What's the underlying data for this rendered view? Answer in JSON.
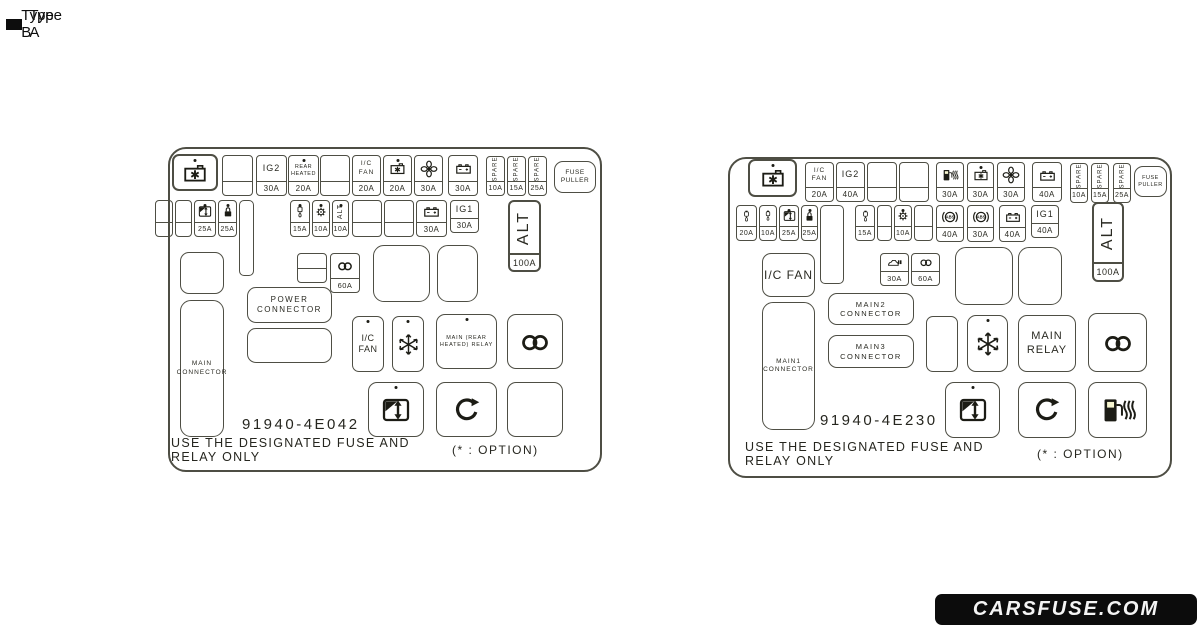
{
  "colors": {
    "panel_bg": "#f7f6d0",
    "line": "#4e4e44",
    "ink": "#2a2a22",
    "logo_bg": "#0c0c0c",
    "logo_text": "#f4f4f4"
  },
  "icons": {
    "battery_charge": "battery-charge-icon",
    "battery": "battery-icon",
    "fan": "fan-icon",
    "power_window": "power-window-icon",
    "door_lock": "door-lock-icon",
    "washer": "washer-fluid-icon",
    "gear": "gear-icon",
    "snowflake": "snowflake-icon",
    "coil": "coil-icon",
    "abs": "abs-icon",
    "fuel_heater": "fuel-heater-icon",
    "rotate": "rotate-arrow-icon",
    "car_wash": "car-wash-icon"
  },
  "type_a": {
    "title": "Type A",
    "part_number": "91940-4E042",
    "warning_line1": "USE THE DESIGNATED FUSE AND",
    "warning_line2": "RELAY ONLY",
    "option_note": "(* :  OPTION)",
    "fuses": {
      "ig2": {
        "label": "IG2",
        "amp": "30A"
      },
      "rear_heated": {
        "label": "REAR HEATED",
        "amp": "20A"
      },
      "ic_fan": {
        "label": "I/C FAN",
        "amp": "20A"
      },
      "battery_charge": {
        "amp": "20A"
      },
      "fan": {
        "amp": "30A"
      },
      "battery_a": {
        "amp": "30A"
      },
      "spare_1": {
        "label": "SPARE",
        "amp": "10A"
      },
      "spare_2": {
        "label": "SPARE",
        "amp": "15A"
      },
      "spare_3": {
        "label": "SPARE",
        "amp": "25A"
      },
      "fuse_puller": {
        "label": "FUSE PULLER"
      },
      "window": {
        "amp": "25A"
      },
      "door_lock": {
        "amp": "25A"
      },
      "washer": {
        "amp": "15A"
      },
      "gear": {
        "amp": "10A"
      },
      "alt_small": {
        "label": "ALT",
        "amp": "10A"
      },
      "battery_b": {
        "amp": "30A"
      },
      "ig1": {
        "label": "IG1",
        "amp": "30A"
      },
      "alt_main": {
        "label": "ALT",
        "amp": "100A"
      },
      "coil": {
        "amp": "60A"
      }
    },
    "boxes": {
      "main_connector": "MAIN CONNECTOR",
      "power_connector": "POWER CONNECTOR",
      "ic_fan_relay": "I/C FAN",
      "main_rear_heated_relay": "MAIN (REAR HEATED) RELAY"
    }
  },
  "type_b": {
    "title": "Type B",
    "part_number": "91940-4E230",
    "warning_line1": "USE THE DESIGNATED FUSE AND",
    "warning_line2": "RELAY ONLY",
    "option_note": "(* :  OPTION)",
    "fuses": {
      "ic_fan": {
        "label": "I/C FAN",
        "amp": "20A"
      },
      "ig2": {
        "label": "IG2",
        "amp": "40A"
      },
      "fuel_heater": {
        "amp": "30A"
      },
      "battery_charge": {
        "amp": "30A"
      },
      "fan": {
        "amp": "30A"
      },
      "battery_a": {
        "amp": "40A"
      },
      "spare_1": {
        "label": "SPARE",
        "amp": "10A"
      },
      "spare_2": {
        "label": "SPARE",
        "amp": "15A"
      },
      "spare_3": {
        "label": "SPARE",
        "amp": "25A"
      },
      "fuse_puller": {
        "label": "FUSE PULLER"
      },
      "washer_1": {
        "amp": "20A"
      },
      "washer_2": {
        "amp": "10A"
      },
      "window": {
        "amp": "25A"
      },
      "door_lock": {
        "amp": "25A"
      },
      "washer_3": {
        "amp": "15A"
      },
      "gear": {
        "amp": "10A"
      },
      "abs_1": {
        "amp": "40A"
      },
      "abs_2": {
        "amp": "30A"
      },
      "battery_b": {
        "amp": "40A"
      },
      "ig1": {
        "label": "IG1",
        "amp": "40A"
      },
      "alt_main": {
        "label": "ALT",
        "amp": "100A"
      },
      "car_wash": {
        "amp": "30A"
      },
      "coil": {
        "amp": "60A"
      }
    },
    "boxes": {
      "ic_fan_box": "I/C FAN",
      "main1_connector": "MAIN1 CONNECTOR",
      "main2_connector": "MAIN2 CONNECTOR",
      "main3_connector": "MAIN3 CONNECTOR",
      "main_relay": "MAIN RELAY"
    }
  },
  "footer": {
    "logo_text": "CARSFUSE.COM"
  }
}
